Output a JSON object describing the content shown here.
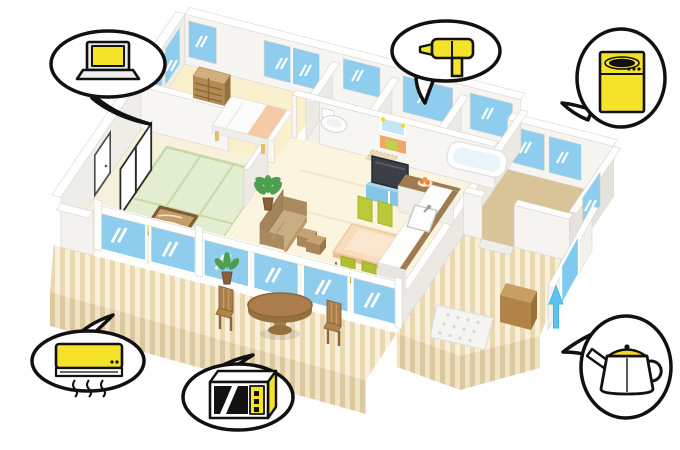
{
  "scene": {
    "description": "Isometric cutaway illustration of a one-story house floor plan surrounded by speech bubbles containing yellow home appliances",
    "background": "#ffffff"
  },
  "bubbles": [
    {
      "id": "laptop",
      "label": "laptop computer",
      "position": "top-left"
    },
    {
      "id": "hair-dryer",
      "label": "hair dryer",
      "position": "top-center"
    },
    {
      "id": "washing-machine",
      "label": "washing machine",
      "position": "top-right"
    },
    {
      "id": "air-conditioner",
      "label": "air conditioner",
      "position": "bottom-left"
    },
    {
      "id": "microwave-oven",
      "label": "microwave oven",
      "position": "bottom-center"
    },
    {
      "id": "electric-kettle",
      "label": "electric kettle",
      "position": "bottom-right"
    }
  ],
  "house": {
    "rooms": [
      {
        "id": "bedroom",
        "floor": "cream"
      },
      {
        "id": "toilet-room",
        "floor": "white"
      },
      {
        "id": "washroom",
        "floor": "peach"
      },
      {
        "id": "bathroom",
        "floor": "white"
      },
      {
        "id": "entrance-hall",
        "floor": "tan"
      },
      {
        "id": "living-dining-room",
        "floor": "cream"
      },
      {
        "id": "kitchen",
        "floor": "cream"
      },
      {
        "id": "tatami-room",
        "floor": "green"
      },
      {
        "id": "hallway",
        "floor": "cream"
      },
      {
        "id": "wood-deck",
        "floor": "striped-wood"
      },
      {
        "id": "side-porch",
        "floor": "striped-wood"
      }
    ],
    "furniture": [
      "wardrobe-chest",
      "bed",
      "toilet",
      "vanity-with-mirror",
      "bath-mat",
      "bathtub",
      "tv",
      "tv-stand",
      "wall-panel",
      "sofa",
      "side-table",
      "dining-table",
      "dining-chairs-x4",
      "kitchen-counter-with-sink",
      "low-tea-table",
      "floor-cushions-x2",
      "shoji-screens",
      "interior-door",
      "potted-plant-x2",
      "garden-round-table",
      "garden-chairs-x2",
      "storage-box",
      "entrance-step",
      "up-arrow-marker"
    ]
  },
  "colors": {
    "appliance_yellow": "#F5E32A",
    "outline_black": "#111111",
    "window_blue": "#8FCDEF",
    "wall_white": "#F7F5F1",
    "floor_cream": "#FAF2D9",
    "tatami_green": "#E3EDD0",
    "deck_light": "#F8F0DC",
    "deck_stripe": "#E9D8B2",
    "wood_brown": "#B28A52",
    "chair_green": "#BCCB3B",
    "vanity_orange": "#F2A566",
    "water_blue": "#5BC4EE"
  }
}
